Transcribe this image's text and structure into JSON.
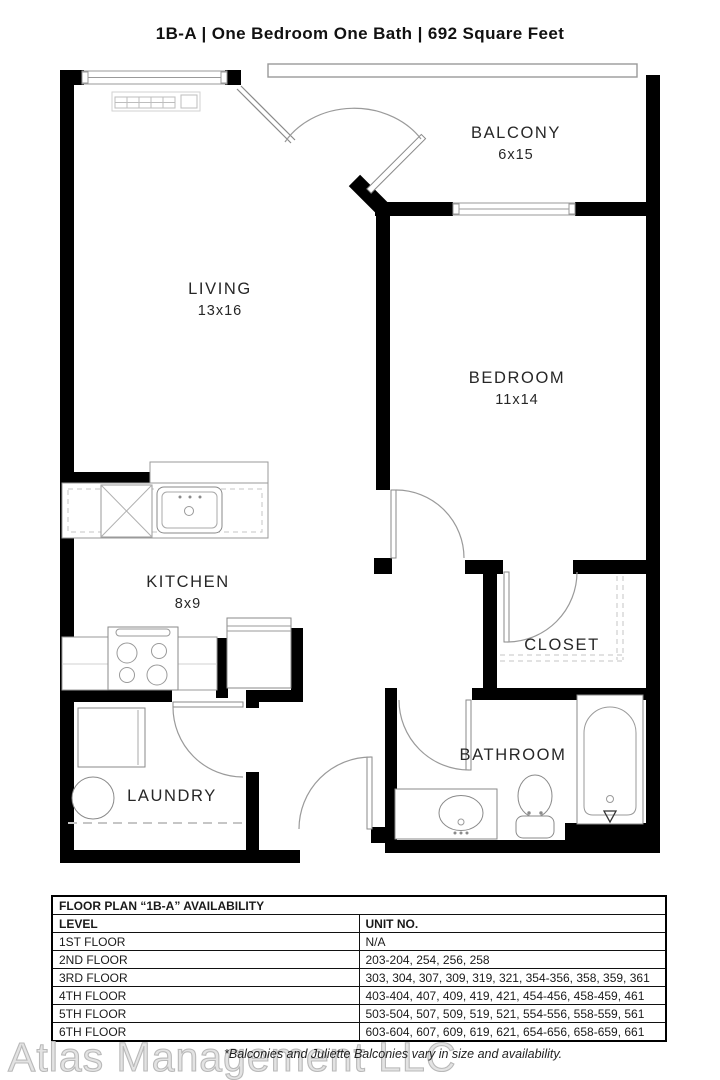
{
  "title": "1B-A | One Bedroom One Bath |  692 Square Feet",
  "rooms": {
    "living": {
      "name": "LIVING",
      "dims": "13x16"
    },
    "bedroom": {
      "name": "BEDROOM",
      "dims": "11x14"
    },
    "balcony": {
      "name": "BALCONY",
      "dims": "6x15"
    },
    "kitchen": {
      "name": "KITCHEN",
      "dims": "8x9"
    },
    "closet": {
      "name": "CLOSET"
    },
    "bathroom": {
      "name": "BATHROOM"
    },
    "laundry": {
      "name": "LAUNDRY"
    }
  },
  "availability_table": {
    "title": "FLOOR PLAN “1B-A” AVAILABILITY",
    "columns": [
      "LEVEL",
      "UNIT NO."
    ],
    "rows": [
      [
        "1ST FLOOR",
        "N/A"
      ],
      [
        "2ND FLOOR",
        "203-204, 254, 256, 258"
      ],
      [
        "3RD FLOOR",
        "303, 304, 307, 309, 319, 321, 354-356, 358, 359, 361"
      ],
      [
        "4TH FLOOR",
        "403-404, 407, 409, 419, 421, 454-456, 458-459, 461"
      ],
      [
        "5TH FLOOR",
        "503-504, 507, 509, 519, 521, 554-556, 558-559, 561"
      ],
      [
        "6TH FLOOR",
        "603-604, 607, 609, 619, 621, 654-656, 658-659, 661"
      ]
    ]
  },
  "footer": {
    "watermark": "Atlas Management LLC",
    "disclaimer": "*Balconies and Juliette Balconies vary in size and availability."
  },
  "colors": {
    "wall": "#000000",
    "fixture_line": "#8a8a8a",
    "arc_line": "#9a9a9a",
    "text": "#272727",
    "watermark": "#e3e3e3"
  }
}
